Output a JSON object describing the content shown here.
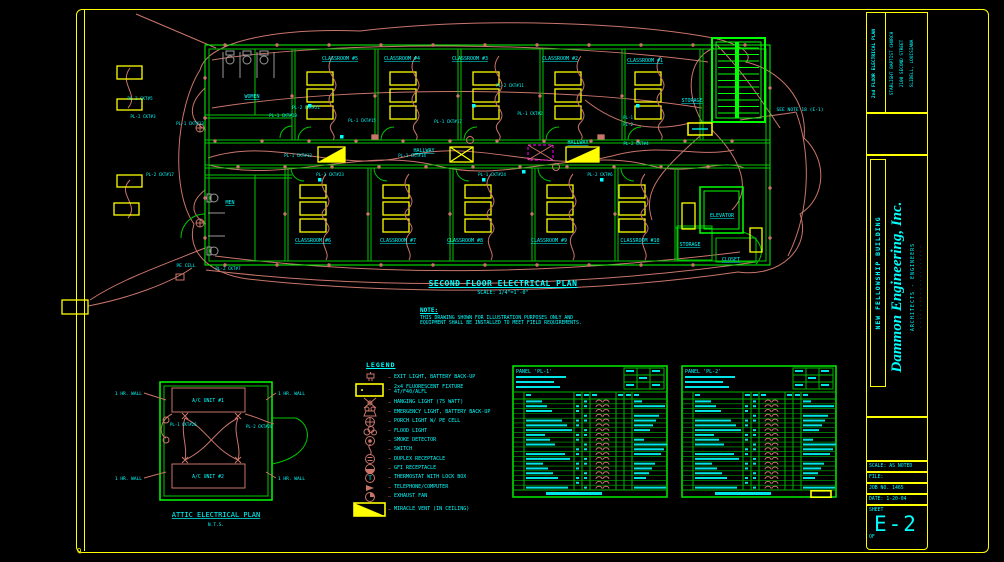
{
  "sheet": {
    "project": {
      "plan_name": "2nd FLOOR ELECTRICAL PLAN",
      "client": "STARLIGHT BAPTIST CHURCH",
      "address1": "2100 SECOND STREET",
      "address2": "SLIDELL, LOUISIANA"
    },
    "building": "NEW FELLOWSHIP BUILDING",
    "firm": {
      "name": "Dammon Engineering, Inc.",
      "sub": "ARCHITECTS - ENGINEERS",
      "fine": "· · · · · · · · · · · · · · · · · · · ·"
    },
    "scale": "SCALE: AS NOTED",
    "file": "FILE:",
    "job": "JOB NO. 1465",
    "date": "DATE: 1-20-04",
    "sheet_word": "SHEET",
    "number": "E-2",
    "of": "OF",
    "corner_mark": "Q"
  },
  "plan": {
    "title": "SECOND FLOOR ELECTRICAL PLAN",
    "scale": "SCALE: 1/4\"=1'-0\"",
    "note_title": "NOTE:",
    "note_line1": "THIS DRAWING SHOWN FOR ILLUSTRATION PURPOSES ONLY AND",
    "note_line2": "EQUIPMENT SHALL BE INSTALLED TO MEET FIELD REQUIREMENTS.",
    "rooms": [
      {
        "label": "WOMEN",
        "x": 212,
        "y": 90
      },
      {
        "label": "MEN",
        "x": 190,
        "y": 196
      },
      {
        "label": "CLASSROOM #5",
        "x": 300,
        "y": 52
      },
      {
        "label": "CLASSROOM #4",
        "x": 362,
        "y": 52
      },
      {
        "label": "CLASSROOM #3",
        "x": 430,
        "y": 52
      },
      {
        "label": "CLASSROOM #2",
        "x": 520,
        "y": 52
      },
      {
        "label": "CLASSROOM #1",
        "x": 605,
        "y": 54
      },
      {
        "label": "STORAGE",
        "x": 652,
        "y": 94
      },
      {
        "label": "HALLWAY",
        "x": 384,
        "y": 144
      },
      {
        "label": "HALLWAY",
        "x": 538,
        "y": 136
      },
      {
        "label": "CLASSROOM #6",
        "x": 273,
        "y": 234
      },
      {
        "label": "CLASSROOM #7",
        "x": 358,
        "y": 234
      },
      {
        "label": "CLASSROOM #8",
        "x": 425,
        "y": 234
      },
      {
        "label": "CLASSROOM #9",
        "x": 509,
        "y": 234
      },
      {
        "label": "CLASSROOM #10",
        "x": 600,
        "y": 234
      },
      {
        "label": "ELEVATOR",
        "x": 682,
        "y": 209
      },
      {
        "label": "STORAGE",
        "x": 650,
        "y": 238
      },
      {
        "label": "CLOSET",
        "x": 691,
        "y": 253
      }
    ],
    "circuits": [
      {
        "label": "PL-2 CKT#5",
        "x": 100,
        "y": 92
      },
      {
        "label": "PL-2 CKT#3",
        "x": 103,
        "y": 110
      },
      {
        "label": "PL-1 CKT#13",
        "x": 150,
        "y": 117
      },
      {
        "label": "PL-1 CKT#19",
        "x": 243,
        "y": 109
      },
      {
        "label": "PL-2 CKT#21",
        "x": 266,
        "y": 101
      },
      {
        "label": "PL-1 CKT#15",
        "x": 322,
        "y": 114
      },
      {
        "label": "PL-1 CKT#17",
        "x": 408,
        "y": 115
      },
      {
        "label": "PL-2 CKT#11",
        "x": 470,
        "y": 79
      },
      {
        "label": "PL-1 CKT#2",
        "x": 490,
        "y": 107
      },
      {
        "label": "PL-1 CKT#12",
        "x": 258,
        "y": 149
      },
      {
        "label": "PL-1 CKT#14",
        "x": 372,
        "y": 149
      },
      {
        "label": "PL-2 CKT#4",
        "x": 596,
        "y": 137
      },
      {
        "label": "PL-2 CKT#17",
        "x": 120,
        "y": 168
      },
      {
        "label": "PL-1 CKT#23",
        "x": 290,
        "y": 168
      },
      {
        "label": "PL-1 CKT#24",
        "x": 452,
        "y": 168
      },
      {
        "label": "PL-2 CKT#6",
        "x": 560,
        "y": 168
      },
      {
        "label": "PL-2 CKT#7",
        "x": 188,
        "y": 262
      },
      {
        "label": "PL-1",
        "x": 588,
        "y": 111
      },
      {
        "label": "PL-2",
        "x": 588,
        "y": 118
      }
    ],
    "pe_cell": {
      "label": "PE CELL",
      "x": 146,
      "y": 259
    },
    "see_note": {
      "label": "SEE NOTE 18 (E-1)",
      "x": 760,
      "y": 103
    }
  },
  "attic": {
    "title": "ATTIC ELECTRICAL PLAN",
    "scale": "N.T.S.",
    "units": [
      "A/C UNIT #1",
      "A/C UNIT #2"
    ],
    "wall_label": "1 HR. WALL",
    "circuits": [
      "PL-1 CKT#26",
      "PL-2 CKT#28"
    ]
  },
  "legend": {
    "title": "LEGEND",
    "items": [
      {
        "icon": "exit-light",
        "label": "EXIT LIGHT, BATTERY BACK-UP"
      },
      {
        "icon": "fluorescent-fixture",
        "label": "2x4 FLUORESCENT FIXTURE",
        "label2": "4T/F40/ALFL"
      },
      {
        "icon": "hanging-light",
        "label": "HANGING LIGHT (75 WATT)"
      },
      {
        "icon": "emergency-light",
        "label": "EMERGENCY LIGHT, BATTERY BACK-UP"
      },
      {
        "icon": "porch-light",
        "label": "PORCH LIGHT W/ PE CELL"
      },
      {
        "icon": "flood-light",
        "label": "FLOOD LIGHT"
      },
      {
        "icon": "smoke-detector",
        "label": "SMOKE DETECTOR"
      },
      {
        "icon": "switch",
        "label": "SWITCH"
      },
      {
        "icon": "duplex-receptacle",
        "label": "DUPLEX RECEPTACLE"
      },
      {
        "icon": "gfi-receptacle",
        "label": "GFI RECEPTACLE"
      },
      {
        "icon": "thermostat",
        "label": "THERMOSTAT WITH LOCK BOX"
      },
      {
        "icon": "telephone",
        "label": "TELEPHONE/COMPUTER"
      },
      {
        "icon": "exhaust-fan",
        "label": "EXHAUST FAN"
      },
      {
        "icon": "miracle-vent",
        "label": "MIRACLE VENT (IN CEILING)"
      }
    ]
  },
  "schedules": [
    {
      "title": "PANEL 'PL-1'",
      "rows": 19,
      "highlight": false
    },
    {
      "title": "PANEL 'PL-2'",
      "rows": 19,
      "highlight": true
    }
  ],
  "colors": {
    "border": "#ffff00",
    "text": "#00ffff",
    "wall": "#00c800",
    "bright": "#00ff00",
    "wire": "#c9756a",
    "magenta": "#ff00ff",
    "gray": "#9a9a9a"
  }
}
